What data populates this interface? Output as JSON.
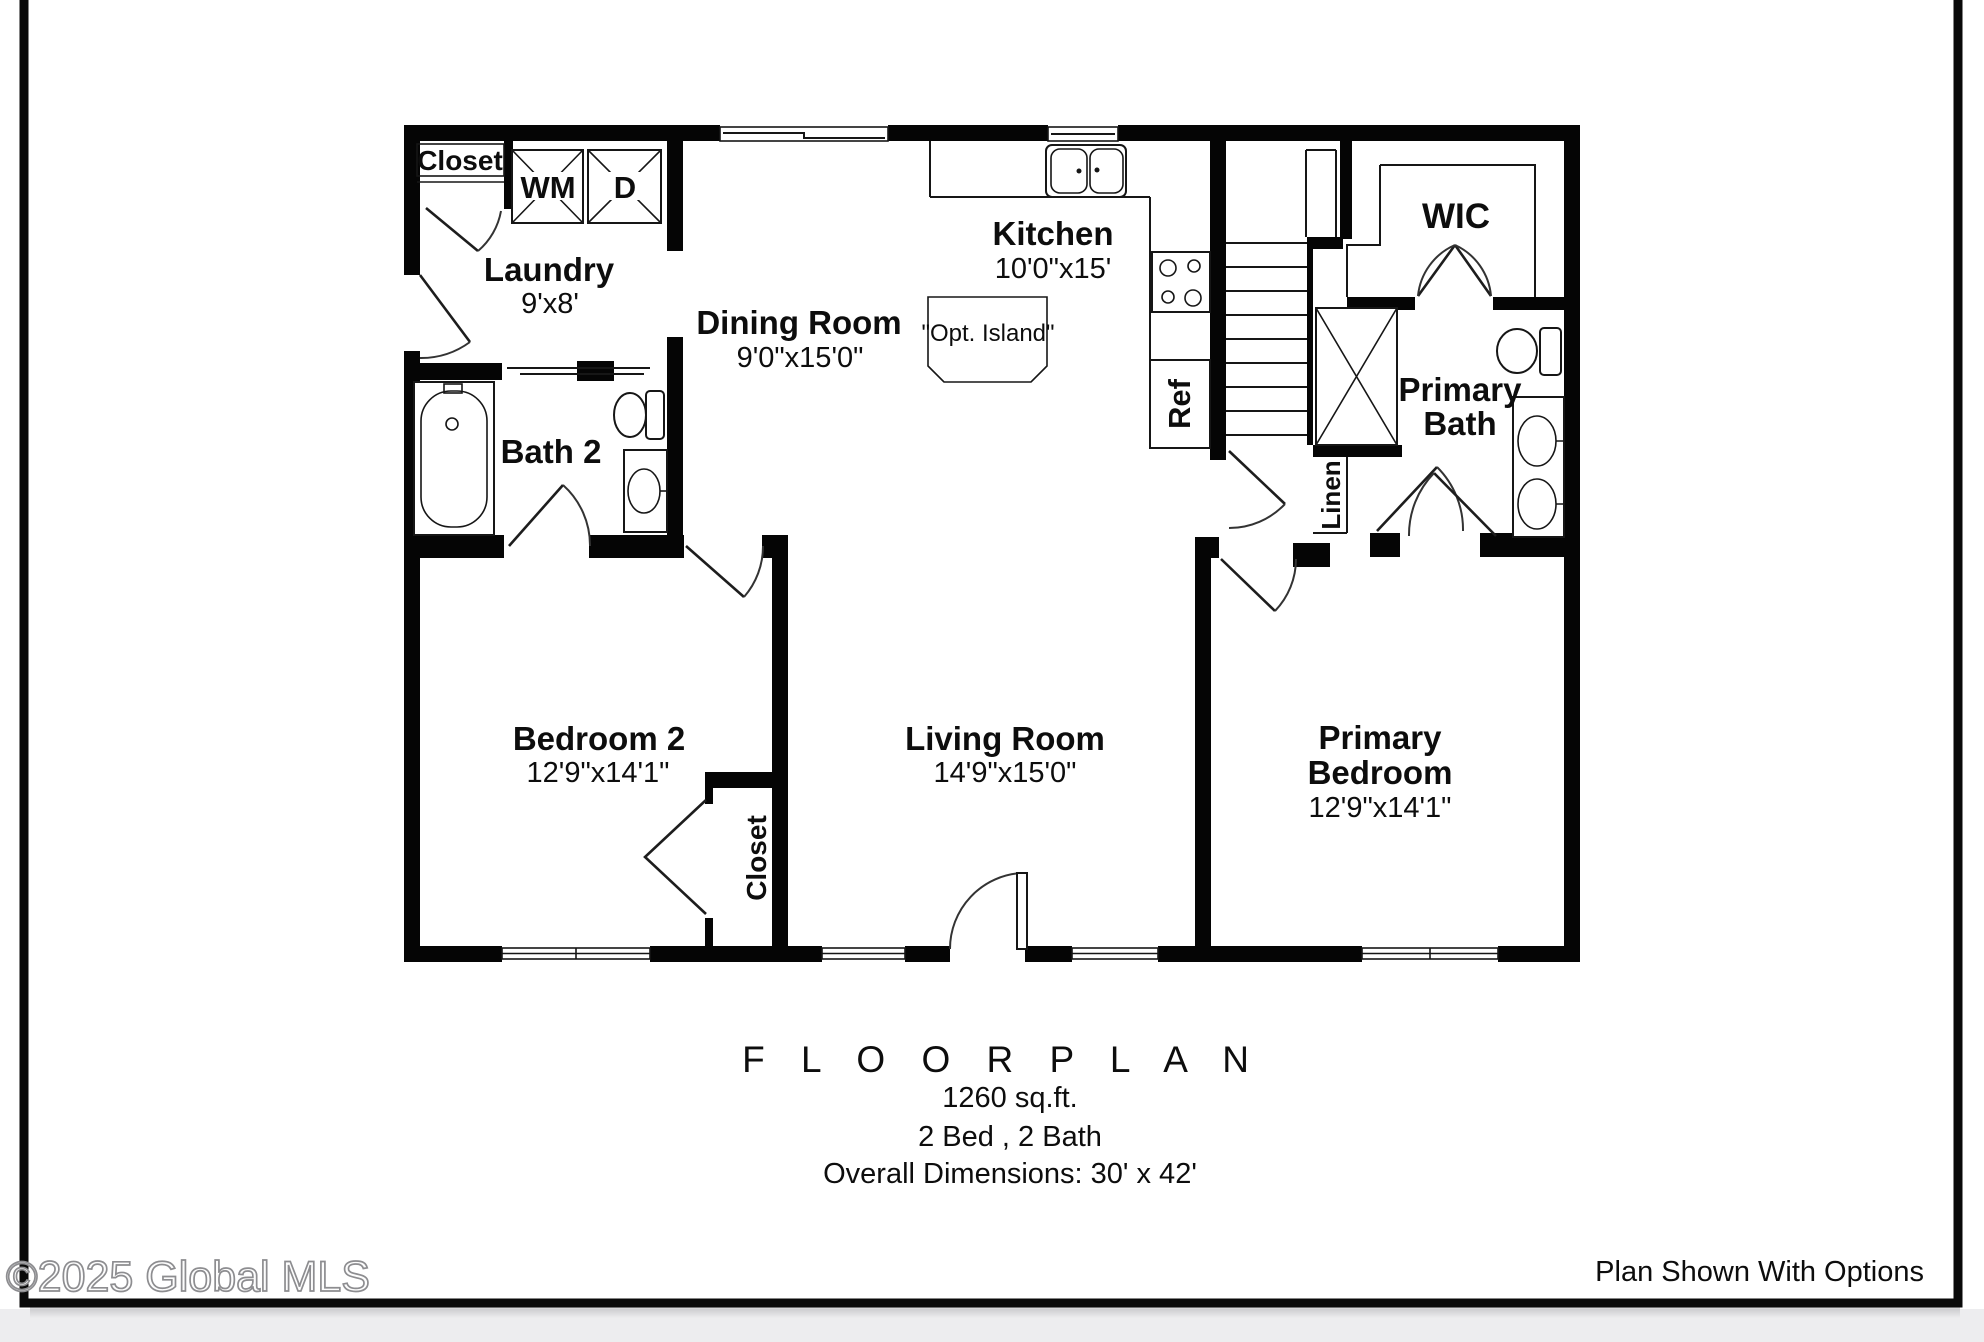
{
  "page": {
    "watermark": "©2025 Global MLS",
    "footer_note": "Plan Shown With Options"
  },
  "title_block": {
    "title": "F L O O R   P L A N",
    "area": "1260 sq.ft.",
    "bed_bath": "2 Bed , 2 Bath",
    "overall": "Overall Dimensions: 30' x 42'"
  },
  "rooms": {
    "laundry": {
      "name": "Laundry",
      "dims": "9'x8'"
    },
    "dining_room": {
      "name": "Dining Room",
      "dims": "9'0\"x15'0\""
    },
    "kitchen": {
      "name": "Kitchen",
      "dims": "10'0\"x15'"
    },
    "bath2": {
      "name": "Bath 2"
    },
    "wic": {
      "name": "WIC"
    },
    "primary_bath": {
      "line1": "Primary",
      "line2": "Bath"
    },
    "bedroom2": {
      "name": "Bedroom 2",
      "dims": "12'9\"x14'1\""
    },
    "living_room": {
      "name": "Living Room",
      "dims": "14'9\"x15'0\""
    },
    "primary_bedroom": {
      "line1": "Primary",
      "line2": "Bedroom",
      "dims": "12'9\"x14'1\""
    }
  },
  "labels": {
    "entry_closet": "Closet",
    "washer": "WM",
    "dryer": "D",
    "fridge": "Ref",
    "linen": "Linen",
    "bedroom2_closet": "Closet",
    "optional_island": "\"Opt. Island\""
  },
  "colors": {
    "wall": "#050505",
    "line": "#161616",
    "paper": "#ffffff",
    "below_frame": "#ededef"
  }
}
